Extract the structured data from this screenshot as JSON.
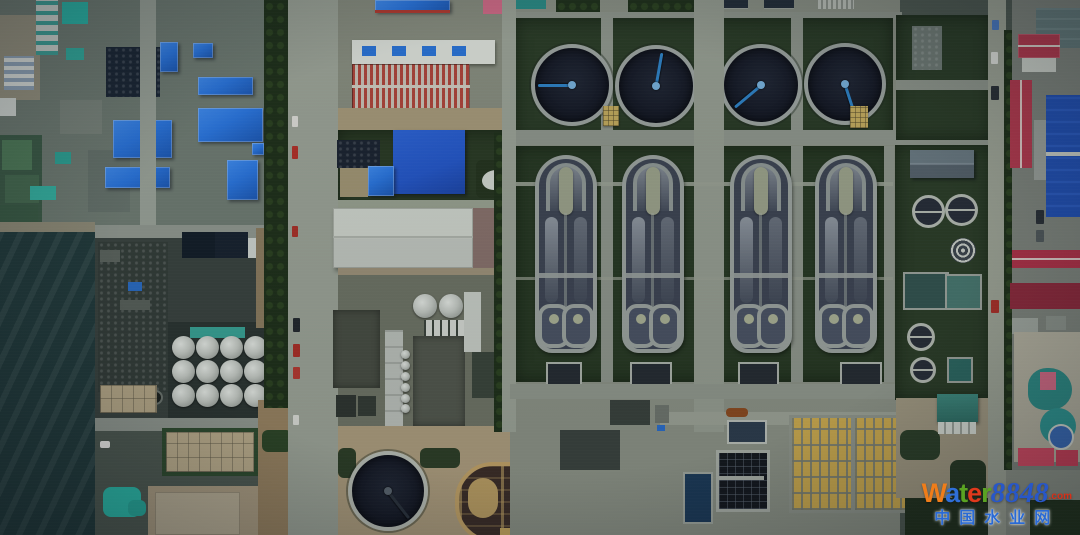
{
  "image": {
    "type": "aerial-photograph",
    "subject": "Top-down dusk aerial view of a municipal wastewater treatment plant (circular clarifiers, oxidation-ditch aeration basins, filter beds) beside an industrial district with blue-roofed factories"
  },
  "watermark": {
    "letters": [
      "W",
      "a",
      "t",
      "e",
      "r"
    ],
    "number": "8848",
    "tld": ".com",
    "subtitle": "中国水业网"
  },
  "palette": {
    "ground": "#4d5850",
    "pavement": "#8a9084",
    "grass": "#2a3b26",
    "water-dark": "#161a26",
    "rim": "#9aa19d",
    "arm-blue": "#2e80c2",
    "basin-water": "#3d4452",
    "roof-blue": "#2a74dc",
    "roof-navy": "#1b2634",
    "roof-red": "#b23a4e",
    "bed-yellow": "#c9a84e",
    "ditch-tan": "#bfa066",
    "ditch-water": "#3b2d27",
    "tarp-teal": "#2cb2a4",
    "sea": "#223a3b",
    "dirt": "#a3947a",
    "wm-w": "#ef7d1a",
    "wm-a": "#2f6fd8",
    "wm-t": "#5aa322",
    "wm-e": "#e0391c",
    "wm-r": "#5aa322",
    "wm-num": "#2857c8",
    "wm-tld": "#d83018",
    "wm-cn": "#2a6ad4"
  }
}
